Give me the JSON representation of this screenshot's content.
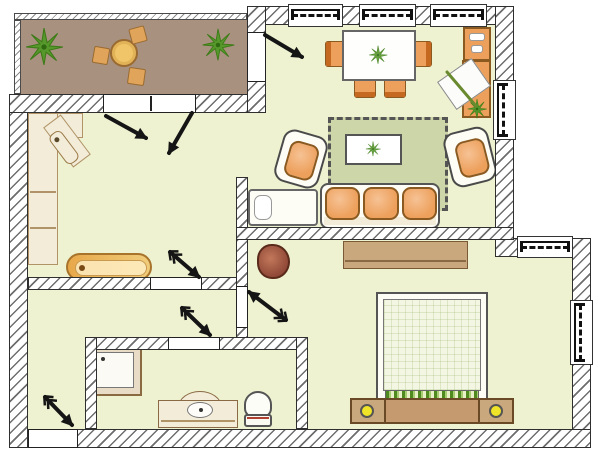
{
  "meta": {
    "title": "Apartment floor plan",
    "kind": "architectural-floor-plan, hand-drawn top view",
    "canvas": {
      "width": 600,
      "height": 450
    }
  },
  "colors": {
    "floor": "#eef2d0",
    "balcony_floor": "#a8917f",
    "wall_fill": "#ffffff",
    "ink": "#2f2f2f",
    "orange": "#eda05c",
    "orange_dk": "#b06a28",
    "cream": "#f3ecd9",
    "cream_ln": "#b09467",
    "rug": "#ccd6a9",
    "wood": "#c9a87d",
    "wood_dk": "#6a4a26",
    "green": "#57982c",
    "green_dk": "#3c7a16",
    "yellow": "#f0e428",
    "pouf": "#9c5240",
    "white": "#fdfdf6"
  },
  "rooms": [
    {
      "id": "balcony",
      "furniture": [
        "potted-plant",
        "round-bistro-table",
        "stool",
        "stool",
        "stool",
        "potted-plant"
      ]
    },
    {
      "id": "dining-area",
      "furniture": [
        "dining-table-with-plant",
        "dining-chair x4",
        "wall-cabinet",
        "desk-with-paper",
        "desk-plant"
      ]
    },
    {
      "id": "living-area",
      "furniture": [
        "fringed-rug",
        "coffee-table-with-plant-motif",
        "armchair x2",
        "three-seat-sofa",
        "daybed"
      ]
    },
    {
      "id": "kitchen",
      "furniture": [
        "corner-counter",
        "corner-sink",
        "bench"
      ]
    },
    {
      "id": "hall",
      "furniture": []
    },
    {
      "id": "bathroom",
      "furniture": [
        "shower-tray",
        "washbasin-vanity",
        "toilet"
      ]
    },
    {
      "id": "bedroom",
      "furniture": [
        "wardrobe-sideboard",
        "beanbag-pouf",
        "double-bed",
        "nightstand x2",
        "bed-lamp x2"
      ]
    }
  ],
  "openings": {
    "window_count": 6,
    "windows": [
      "top-wall-1",
      "top-wall-2",
      "top-wall-3",
      "right-upper-wall",
      "bedroom-nook-top",
      "bedroom-right-wall"
    ],
    "doors": [
      "entrance-door",
      "balcony-french-door",
      "balcony-side-door",
      "kitchen-door",
      "bathroom-door",
      "bedroom-door"
    ],
    "door_swing_arrow_count": 7
  }
}
